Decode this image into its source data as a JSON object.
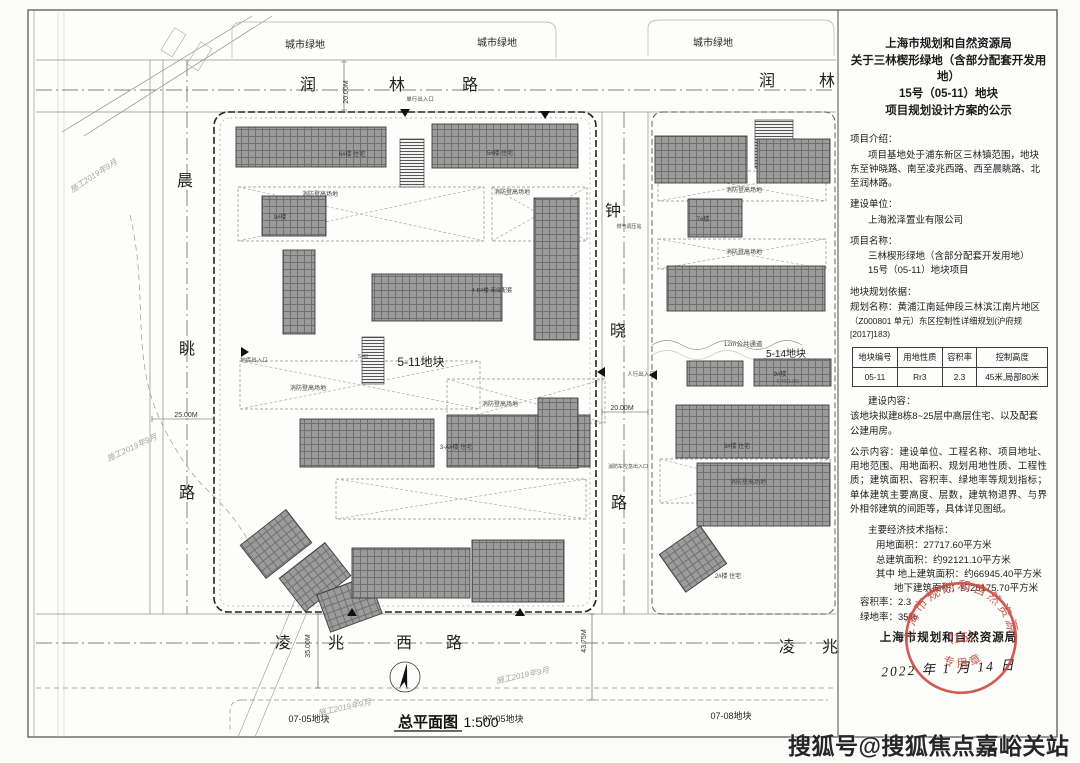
{
  "watermark": "搜狐号@搜狐焦点嘉峪关站",
  "panel": {
    "title_lines": [
      "上海市规划和自然资源局",
      "关于三林楔形绿地（含部分配套开发用地）",
      "15号（05-11）地块",
      "项目规划设计方案的公示"
    ],
    "intro_label": "项目介绍：",
    "intro_text": "项目基地处于浦东新区三林镇范围，地块东至钟晓路、南至凌兆西路、西至晨眺路、北至润林路。",
    "builder_label": "建设单位：",
    "builder_text": "上海淞泽置业有限公司",
    "project_label": "项目名称：",
    "project_line1": "三林楔形绿地（含部分配套开发用地）",
    "project_line2": "15号（05-11）地块项目",
    "basis_label": "地块规划依据：",
    "basis_line1": "规划名称：黄浦江南延伸段三林滨江南片地区",
    "basis_line2": "（Z000801 单元）东区控制性详细规划(沪府规[2017]183)",
    "table": {
      "headers": [
        "地块编号",
        "用地性质",
        "容积率",
        "控制高度"
      ],
      "rows": [
        [
          "05-11",
          "Rr3",
          "2.3",
          "45米,局部80米"
        ]
      ]
    },
    "content_label": "建设内容：",
    "content_text": "该地块拟建8栋8~25层中高层住宅、以及配套公建用房。",
    "publicity_text": "公示内容：建设单位、工程名称、项目地址、用地范围、用地面积、规划用地性质、工程性质；建筑面积、容积率、绿地率等规划指标；单体建筑主要高度、层数，建筑物退界、与界外相邻建筑的间距等，具体详见图纸。",
    "indicators_label": "主要经济技术指标：",
    "indicators": [
      "用地面积：27717.60平方米",
      "总建筑面积：约92121.10平方米",
      "其中 地上建筑面积：约66945.40平方米",
      "地下建筑面积：约25175.70平方米",
      "容积率：2.3",
      "绿地率：35%"
    ],
    "footer_org": "上海市规划和自然资源局",
    "footer_date": "2022 年 1 月 14 日",
    "stamp": {
      "ring_text": "上海市规划和自然资源局",
      "center_text": "（15）",
      "bottom_text": "专用章",
      "color": "#c9463d"
    }
  },
  "map": {
    "plan_title": "总平面图",
    "plan_scale": "1:500",
    "labels": [
      {
        "t": "城市绿地",
        "x": 305,
        "y": 48,
        "s": 10
      },
      {
        "t": "城市绿地",
        "x": 497,
        "y": 46,
        "s": 10
      },
      {
        "t": "城市绿地",
        "x": 713,
        "y": 46,
        "s": 10
      },
      {
        "t": "润",
        "x": 308,
        "y": 90,
        "s": 16,
        "f": 1
      },
      {
        "t": "林",
        "x": 397,
        "y": 90,
        "s": 16,
        "f": 1
      },
      {
        "t": "路",
        "x": 470,
        "y": 90,
        "s": 16,
        "f": 1
      },
      {
        "t": "润",
        "x": 767,
        "y": 86,
        "s": 16,
        "f": 1
      },
      {
        "t": "林",
        "x": 827,
        "y": 86,
        "s": 16,
        "f": 1
      },
      {
        "t": "晨",
        "x": 185,
        "y": 186,
        "s": 16,
        "f": 1
      },
      {
        "t": "眺",
        "x": 187,
        "y": 354,
        "s": 16,
        "f": 1
      },
      {
        "t": "路",
        "x": 187,
        "y": 498,
        "s": 16,
        "f": 1
      },
      {
        "t": "钟",
        "x": 613,
        "y": 216,
        "s": 16,
        "f": 1
      },
      {
        "t": "晓",
        "x": 618,
        "y": 336,
        "s": 16,
        "f": 1
      },
      {
        "t": "路",
        "x": 619,
        "y": 508,
        "s": 16,
        "f": 1
      },
      {
        "t": "凌",
        "x": 283,
        "y": 648,
        "s": 16,
        "f": 1
      },
      {
        "t": "兆",
        "x": 336,
        "y": 648,
        "s": 16,
        "f": 1
      },
      {
        "t": "西",
        "x": 404,
        "y": 648,
        "s": 16,
        "f": 1
      },
      {
        "t": "路",
        "x": 454,
        "y": 648,
        "s": 16,
        "f": 1
      },
      {
        "t": "凌",
        "x": 787,
        "y": 652,
        "s": 16,
        "f": 1
      },
      {
        "t": "兆",
        "x": 830,
        "y": 652,
        "s": 16,
        "f": 1
      },
      {
        "t": "5-11地块",
        "x": 421,
        "y": 366,
        "s": 12
      },
      {
        "t": "5-14地块",
        "x": 786,
        "y": 357,
        "s": 10
      },
      {
        "t": "07-05地块",
        "x": 309,
        "y": 722,
        "s": 9
      },
      {
        "t": "07-05地块",
        "x": 503,
        "y": 722,
        "s": 9
      },
      {
        "t": "07-08地块",
        "x": 731,
        "y": 719,
        "s": 9
      },
      {
        "t": "20.00M",
        "x": 348,
        "y": 92,
        "s": 7,
        "r": -90,
        "c": "#333"
      },
      {
        "t": "25.00M",
        "x": 186,
        "y": 417,
        "s": 7,
        "c": "#333"
      },
      {
        "t": "20.00M",
        "x": 622,
        "y": 410,
        "s": 7,
        "c": "#333"
      },
      {
        "t": "35.00M",
        "x": 310,
        "y": 646,
        "s": 7,
        "r": -90,
        "c": "#333"
      },
      {
        "t": "43.75M",
        "x": 586,
        "y": 641,
        "s": 7,
        "r": -90,
        "c": "#333"
      },
      {
        "t": "12m公共通道",
        "x": 743,
        "y": 346,
        "s": 6.5,
        "c": "#444"
      },
      {
        "t": "消防登高场地",
        "x": 320,
        "y": 196,
        "s": 6,
        "c": "#444"
      },
      {
        "t": "消防登高场地",
        "x": 512,
        "y": 194,
        "s": 6,
        "c": "#444"
      },
      {
        "t": "消防登高场地",
        "x": 308,
        "y": 390,
        "s": 6,
        "c": "#444"
      },
      {
        "t": "消防登高场地",
        "x": 500,
        "y": 406,
        "s": 6,
        "c": "#444"
      },
      {
        "t": "消防登高场地",
        "x": 744,
        "y": 192,
        "s": 6,
        "c": "#444"
      },
      {
        "t": "消防登高场地",
        "x": 744,
        "y": 254,
        "s": 6,
        "c": "#444"
      },
      {
        "t": "消防登高场地",
        "x": 748,
        "y": 484,
        "s": 6,
        "c": "#444"
      },
      {
        "t": "单行出入口",
        "x": 420,
        "y": 101,
        "s": 5.5,
        "c": "#444"
      },
      {
        "t": "人行出入口",
        "x": 641,
        "y": 376,
        "s": 5.5,
        "c": "#444"
      },
      {
        "t": "地库出入口",
        "x": 254,
        "y": 362,
        "s": 5.5,
        "c": "#444"
      },
      {
        "t": "消防车应急出入口",
        "x": 628,
        "y": 468,
        "s": 5,
        "c": "#444"
      },
      {
        "t": "燃气调压站",
        "x": 629,
        "y": 228,
        "s": 5,
        "c": "#444"
      },
      {
        "t": "6#楼 住宅",
        "x": 352,
        "y": 156,
        "s": 6,
        "c": "#333"
      },
      {
        "t": "5#楼 住宅",
        "x": 500,
        "y": 155,
        "s": 6,
        "c": "#333"
      },
      {
        "t": "9#楼",
        "x": 280,
        "y": 219,
        "s": 6,
        "c": "#333"
      },
      {
        "t": "3-A#楼 住宅",
        "x": 456,
        "y": 449,
        "s": 6,
        "c": "#333"
      },
      {
        "t": "4-B#楼 商业配套",
        "x": 492,
        "y": 292,
        "s": 5.5,
        "c": "#333"
      },
      {
        "t": "7#楼",
        "x": 703,
        "y": 221,
        "s": 6,
        "c": "#333"
      },
      {
        "t": "9#楼",
        "x": 780,
        "y": 376,
        "s": 6,
        "c": "#333"
      },
      {
        "t": "3#楼 住宅",
        "x": 737,
        "y": 448,
        "s": 6,
        "c": "#333"
      },
      {
        "t": "2#楼 住宅",
        "x": 728,
        "y": 578,
        "s": 6,
        "c": "#333"
      },
      {
        "t": "5.40",
        "x": 363,
        "y": 358,
        "s": 5,
        "c": "#555"
      },
      {
        "t": "6.40(1.85)",
        "x": 788,
        "y": 383,
        "s": 5,
        "c": "#555"
      },
      {
        "t": "施工2019年9月",
        "x": 95,
        "y": 178,
        "s": 8,
        "r": -33,
        "c": "#a6a6a6",
        "i": 1
      },
      {
        "t": "施工2019年9月",
        "x": 133,
        "y": 450,
        "s": 8,
        "r": -25,
        "c": "#a6a6a6",
        "i": 1
      },
      {
        "t": "施工2019年9月",
        "x": 345,
        "y": 710,
        "s": 8,
        "r": -12,
        "c": "#a6a6a6",
        "i": 1
      },
      {
        "t": "施工2019年9月",
        "x": 523,
        "y": 678,
        "s": 8,
        "r": -12,
        "c": "#a6a6a6",
        "i": 1
      }
    ],
    "buildings": [
      [
        236,
        127,
        150,
        40
      ],
      [
        432,
        124,
        146,
        44
      ],
      [
        262,
        196,
        64,
        40
      ],
      [
        283,
        250,
        32,
        84
      ],
      [
        372,
        274,
        130,
        47
      ],
      [
        534,
        198,
        45,
        142
      ],
      [
        300,
        419,
        134,
        48
      ],
      [
        447,
        415,
        143,
        52
      ],
      [
        538,
        398,
        40,
        70
      ],
      [
        247,
        523,
        58,
        42,
        -38
      ],
      [
        286,
        556,
        58,
        42,
        -38
      ],
      [
        322,
        584,
        55,
        40,
        -20
      ],
      [
        352,
        548,
        118,
        50
      ],
      [
        472,
        540,
        92,
        62
      ],
      [
        655,
        136,
        92,
        47
      ],
      [
        757,
        139,
        73,
        44
      ],
      [
        688,
        199,
        54,
        38
      ],
      [
        667,
        266,
        158,
        45
      ],
      [
        687,
        361,
        56,
        25
      ],
      [
        754,
        359,
        77,
        27
      ],
      [
        676,
        405,
        153,
        53
      ],
      [
        697,
        463,
        133,
        63
      ],
      [
        668,
        536,
        50,
        46,
        -35
      ]
    ],
    "ramps": [
      [
        400,
        139,
        24,
        48
      ],
      [
        362,
        337,
        22,
        47
      ],
      [
        755,
        120,
        38,
        48
      ]
    ],
    "xlanes": [
      [
        238,
        187,
        246,
        54
      ],
      [
        492,
        187,
        95,
        54
      ],
      [
        240,
        361,
        240,
        48
      ],
      [
        447,
        379,
        158,
        44
      ],
      [
        336,
        479,
        250,
        40
      ],
      [
        658,
        171,
        168,
        30
      ],
      [
        658,
        239,
        168,
        30
      ],
      [
        660,
        459,
        170,
        44
      ]
    ]
  }
}
